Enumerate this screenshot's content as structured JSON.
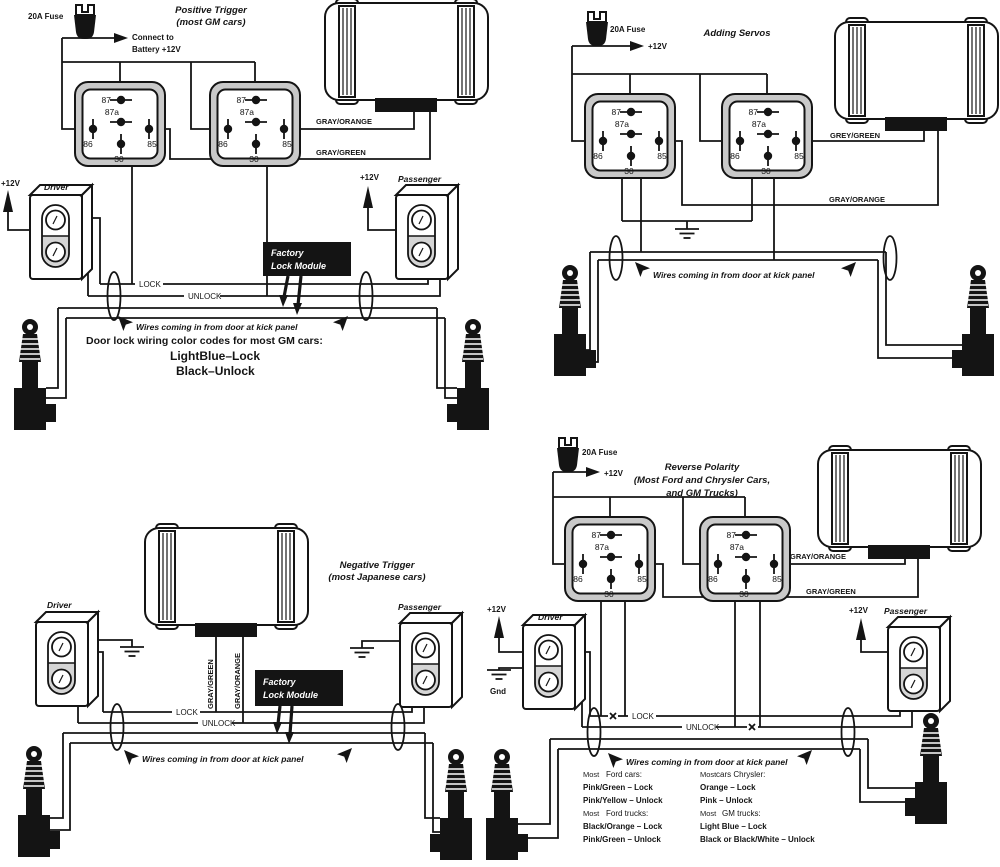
{
  "relay_pins": {
    "p87": "87",
    "p87a": "87a",
    "p86": "86",
    "p85": "85",
    "p30": "30"
  },
  "panels": {
    "positive": {
      "title": "Positive Trigger",
      "subtitle": "(most GM cars)",
      "fuse_label": "20A Fuse",
      "connect1": "Connect to",
      "connect2": "Battery +12V",
      "v12": "+12V",
      "driver": "Driver",
      "passenger": "Passenger",
      "lock": "LOCK",
      "unlock": "UNLOCK",
      "gray_orange": "GRAY/ORANGE",
      "gray_green": "GRAY/GREEN",
      "factory1": "Factory",
      "factory2": "Lock Module",
      "note": "Wires coming in from door at kick panel",
      "codes_heading": "Door lock wiring color codes for most GM cars:",
      "code_lock": "LightBlue–Lock",
      "code_unlock": "Black–Unlock"
    },
    "servos": {
      "title": "Adding Servos",
      "fuse_label": "20A Fuse",
      "v12": "+12V",
      "grey_green": "GREY/GREEN",
      "gray_orange": "GRAY/ORANGE",
      "note": "Wires coming in from door at kick panel"
    },
    "negative": {
      "title": "Negative Trigger",
      "subtitle": "(most Japanese cars)",
      "driver": "Driver",
      "passenger": "Passenger",
      "lock": "LOCK",
      "unlock": "UNLOCK",
      "gray_green": "GRAY/GREEN",
      "gray_orange": "GRAY/ORANGE",
      "factory1": "Factory",
      "factory2": "Lock Module",
      "note": "Wires coming in from door at kick panel"
    },
    "reverse": {
      "title": "Reverse Polarity",
      "subtitle1": "(Most Ford and Chrysler Cars,",
      "subtitle2": "and GM Trucks)",
      "fuse_label": "20A Fuse",
      "v12": "+12V",
      "gnd": "Gnd",
      "driver": "Driver",
      "passenger": "Passenger",
      "lock": "LOCK",
      "unlock": "UNLOCK",
      "gray_orange": "GRAY/ORANGE",
      "gray_green": "GRAY/GREEN",
      "note": "Wires coming in from door at kick panel",
      "codes": {
        "most": "Most",
        "ford_cars": "Ford cars:",
        "pg_lock": "Pink/Green – Lock",
        "py_unlock": "Pink/Yellow – Unlock",
        "ford_trucks": "Ford trucks:",
        "bo_lock": "Black/Orange – Lock",
        "pg_unlock": "Pink/Green – Unlock",
        "cars_chrysler": "cars Chrysler:",
        "o_lock": "Orange – Lock",
        "p_unlock": "Pink – Unlock",
        "gm_trucks": "GM trucks:",
        "lb_lock": "Light Blue – Lock",
        "bbw_unlock": "Black or Black/White – Unlock"
      }
    }
  }
}
